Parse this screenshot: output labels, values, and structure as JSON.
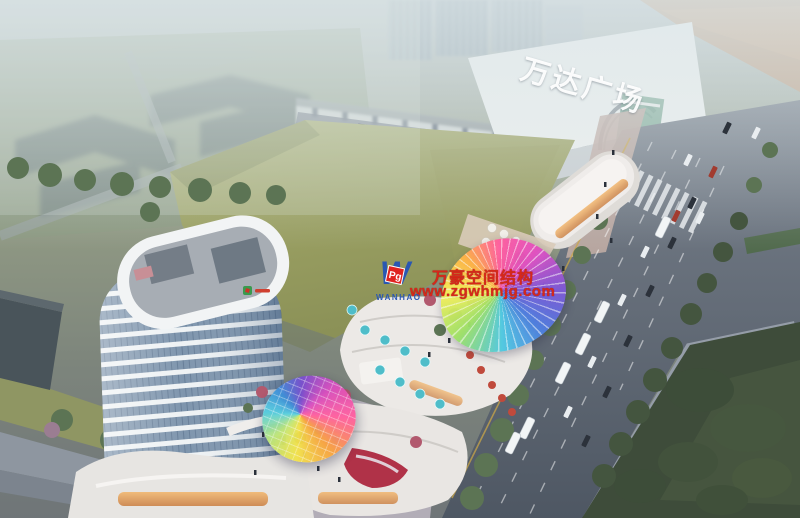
{
  "scene": {
    "mall_sign": "万达广场",
    "watermark": {
      "line1": "万豪空间结构",
      "line2": "www.zgwhmjg.com",
      "logo_text": "WANHAO",
      "logo_badge": "Pg",
      "text_color": "#d6281a",
      "logo_color": "#2a57b2",
      "badge_color": "#e02420"
    },
    "palette": {
      "haze": "#b7c2c6",
      "field_green": "#a0a567",
      "park_green": "#3e4c3a",
      "road_grey": "#5d6672",
      "tower_glass": "#7e95ad",
      "canopy_rainbow": [
        "#f8ef5a",
        "#ffb347",
        "#ff5f9e",
        "#e04fc0",
        "#8059d8",
        "#4f7fe0",
        "#4fc8e0"
      ]
    }
  }
}
